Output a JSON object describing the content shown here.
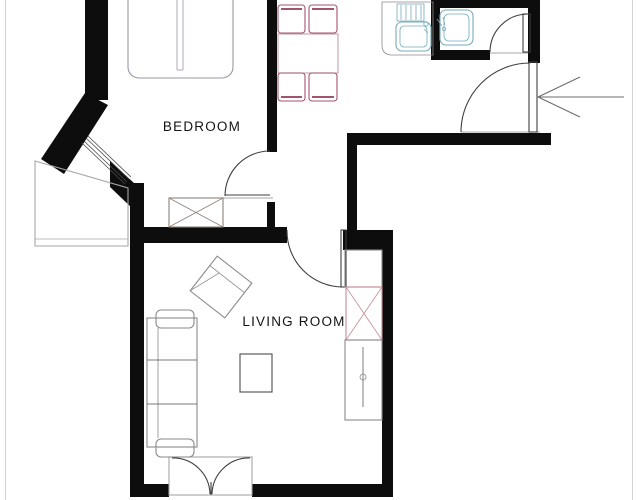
{
  "plan": {
    "type": "apartment-floor-plan",
    "rooms": [
      {
        "id": "bedroom",
        "label": "BEDROOM"
      },
      {
        "id": "living_room",
        "label": "LIVING ROOM"
      }
    ],
    "entrance": {
      "marker": "arrow",
      "direction": "left"
    },
    "furniture": {
      "bedroom": [
        "double-bed",
        "wardrobe"
      ],
      "hall_kitchen": [
        "dining-table",
        "chair",
        "chair",
        "chair",
        "chair",
        "kitchen-sink"
      ],
      "bathroom": [
        "washbasin"
      ],
      "living_room": [
        "sofa",
        "armchair",
        "coffee-table",
        "cabinet",
        "wardrobe",
        "shelf-unit"
      ],
      "outside": [
        "side-balcony",
        "balcony-double-door"
      ]
    },
    "colors": {
      "wall": "#0d0d0d",
      "dining_chair": "#a2546f",
      "dining_table": "#c3a0af",
      "plumbing": "#76abb9",
      "bed_outline": "#9d95a5",
      "furniture_gray": "#8a8a8a",
      "furniture_dark": "#4d4d4d",
      "bedroom_wardrobe": "#8d8179",
      "living_wardrobe": "#c48e95",
      "door_line": "#3f3f3f",
      "window_line": "#4a4a4a",
      "balcony_outline": "#a6a6a6",
      "arrow": "#6e6e6e",
      "scan_edge": "#c9c9c9",
      "label_text": "#141414"
    }
  }
}
